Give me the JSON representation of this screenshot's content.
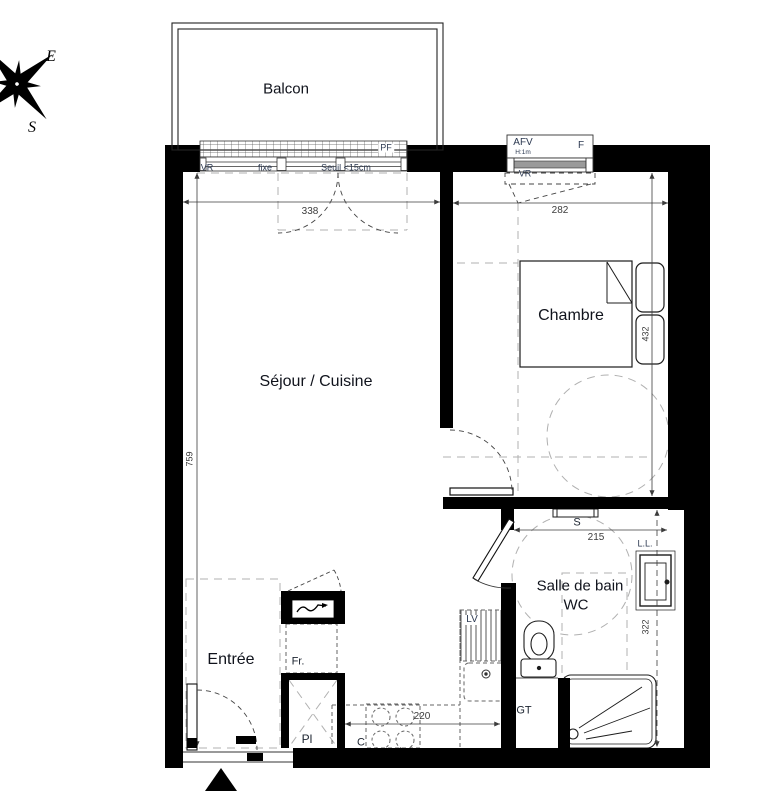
{
  "labels": {
    "balcony": "Balcon",
    "living": "Séjour / Cuisine",
    "bedroom": "Chambre",
    "bathroom_line1": "Salle de bain",
    "bathroom_line2": "WC",
    "entrance": "Entrée"
  },
  "compass": {
    "east": "E",
    "south": "S"
  },
  "openings": {
    "pf": "PF",
    "vr_living": "VR",
    "fixed": "fixe",
    "threshold": "Seuil <15cm",
    "afv": "AFV",
    "afv_height": "H:1m",
    "window_f": "F",
    "vr_bedroom": "VR"
  },
  "fixtures": {
    "washing_machine": "L.L.",
    "towel_rail": "S",
    "dishwasher": "LV",
    "fridge": "Fr.",
    "closet": "Pl",
    "cooktop": "C",
    "technical_duct": "GT"
  },
  "dimensions_cm": {
    "living_width": "338",
    "bedroom_width": "282",
    "living_depth": "759",
    "bedroom_depth": "432",
    "bathroom_width": "215",
    "bathroom_depth": "322",
    "kitchen_counter": "220"
  },
  "colors": {
    "wall": "#000000",
    "dashed_guide": "#b0b0b0",
    "dimension_text": "#3c3c3c",
    "label_text": "#10131c"
  }
}
